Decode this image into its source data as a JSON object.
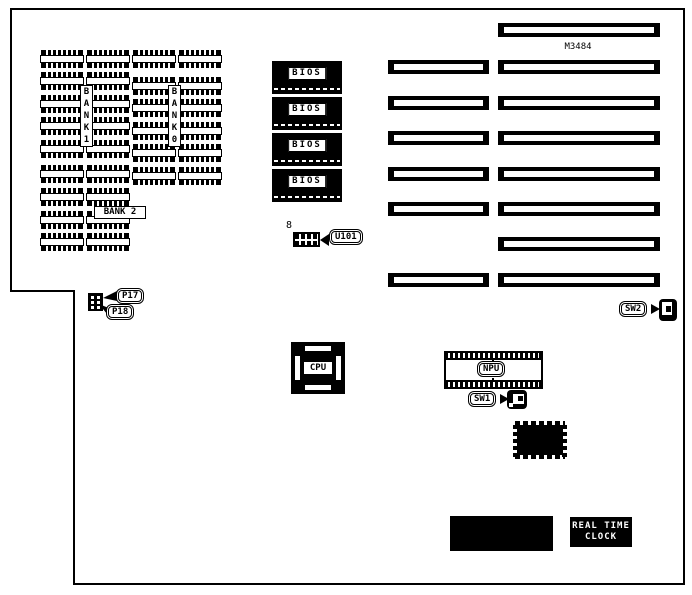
{
  "memory": {
    "bank1_label": "B\nA\nN\nK\n1",
    "bank0_label": "B\nA\nN\nK\n0",
    "bank2_label": "BANK 2",
    "bank1_rows": 5,
    "bank0_rows": 6,
    "bank2_rows": 4,
    "columns_per_bank": 2
  },
  "bios_chips": {
    "labels": [
      "BIOS",
      "BIOS",
      "BIOS",
      "BIOS"
    ]
  },
  "u101": {
    "pin_count": "8",
    "label": "U101"
  },
  "expansion_slots": {
    "part_note": "M3484",
    "left_column_count": 6,
    "right_column_count": 8
  },
  "connectors": {
    "p17": "P17",
    "p18": "P18",
    "sw1": "SW1",
    "sw2": "SW2"
  },
  "chips": {
    "cpu": "CPU",
    "npu": "NPU"
  },
  "rtc": {
    "line1": "REAL TIME",
    "line2": "CLOCK"
  }
}
